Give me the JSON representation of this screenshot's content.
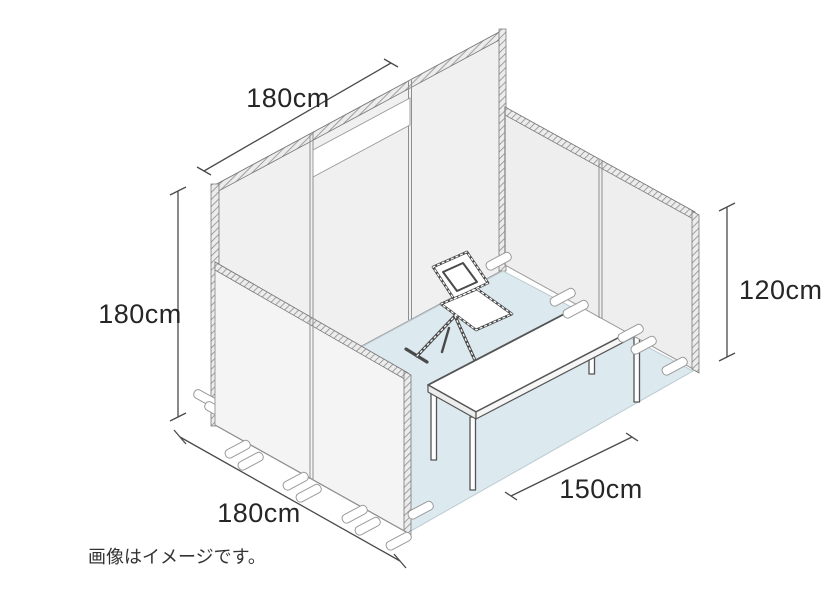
{
  "diagram": {
    "caption": "画像はイメージです。",
    "dimensions": {
      "top": "180cm",
      "left": "180cm",
      "bottom": "180cm",
      "right": "120cm",
      "front": "150cm"
    },
    "objects": {
      "back_wall": "booth back wall (3 panels, white sign band)",
      "left_wall": "left side wall (low panels)",
      "right_wall": "right side wall (low panel)",
      "floor": "blue floor mat",
      "table": "folding table",
      "chair": "folding chair"
    },
    "colors": {
      "floor": "#dce9ef",
      "wall": "#f1f1f1",
      "line": "#4a4a4a",
      "accent_band": "#ffffff"
    }
  }
}
